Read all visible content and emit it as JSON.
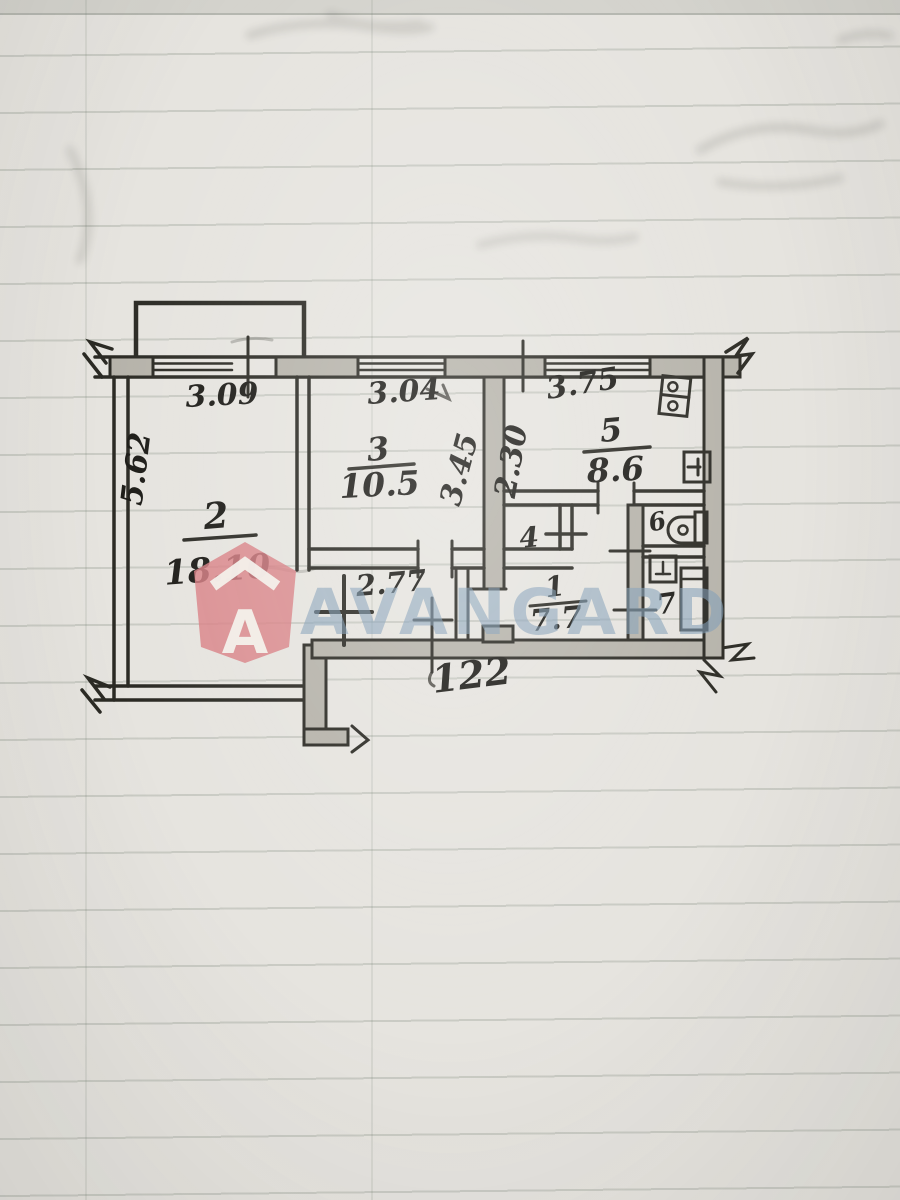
{
  "watermark": {
    "brand": "AVANGARD",
    "logo_letter": "A",
    "shield_color": "#d87e83",
    "text_color": "#7f9cb5"
  },
  "plan": {
    "labels": {
      "dim_top_left": "3.09",
      "dim_top_middle": "3.04",
      "dim_top_right": "3.75",
      "dim_left_vertical": "5.62",
      "dim_room3_right": "3.45",
      "dim_kitchen_left": "2.30",
      "dim_hallway": "2.77",
      "dim_bottom_door": "122",
      "room1_num": "1",
      "room1_area": "7.7",
      "room2_num": "2",
      "room2_area": "18.10",
      "room3_num": "3",
      "room3_area": "10.5",
      "room4_num": "4",
      "room5_num": "5",
      "room5_area": "8.6",
      "room6_num": "6",
      "room7_num": "7"
    },
    "fixtures": [
      "stove",
      "kitchen-sink",
      "toilet",
      "washbasin",
      "bathtub"
    ],
    "colors": {
      "ink": "#2b2a24",
      "wall_shade": "#b6b3aa",
      "paper": "#e6e4df"
    }
  }
}
